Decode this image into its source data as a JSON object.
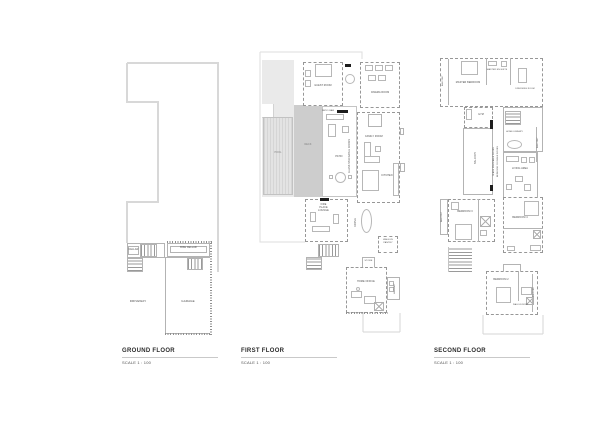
{
  "titles": {
    "ground": {
      "title": "GROUND FLOOR",
      "scale": "SCALE 1 : 100"
    },
    "first": {
      "title": "FIRST FLOOR",
      "scale": "SCALE 1 : 100"
    },
    "second": {
      "title": "SECOND FLOOR",
      "scale": "SCALE 1 : 100"
    }
  },
  "ground": {
    "rooms": {
      "bike_cellar": "BIKE CELLAR",
      "cellar": "CELLAR",
      "driveway": "DRIVEWAY",
      "garage": "GARAGE"
    }
  },
  "first": {
    "rooms": {
      "guest_room": "GUEST ROOM",
      "cinema_room": "CINEMA ROOM",
      "patio_bar": "PATIO BAR",
      "family_room": "FAMILY ROOM",
      "pool": "POOL",
      "deck": "DECK",
      "patio": "PATIO",
      "glass_doors": "GLASS STACKABLE DOORS",
      "kitchen": "KITCHEN",
      "fireplace_lounge": "FIRE PLACE LOUNGE",
      "dining": "DINING",
      "walk_in_pantry": "WALK-IN PANTRY",
      "store": "STORE",
      "home_office": "HOME OFFICE",
      "laundry": "LAUNDRY"
    }
  },
  "second": {
    "rooms": {
      "balcony": "BALCONY",
      "master_bedroom": "MASTER BEDROOM",
      "master_ensuite": "MASTER EN-SUITE",
      "dressing_room": "DRESSING ROOM",
      "gym": "GYM",
      "home_library": "HOME LIBRARY",
      "glass_doors": "GLASS STACKABLE DOORS",
      "double_doors": "BEDROOM 3 DOUBLE DOORS",
      "living_area": "LIVING AREA",
      "bedroom_2": "BEDROOM 2",
      "bedroom_3": "BEDROOM 3",
      "bedroom_4": "BEDROOM 4",
      "walk_in_robe": "WALK-IN ROBE"
    }
  },
  "colors": {
    "wall": "#8f8f8f",
    "thin_line": "#b3b3b3",
    "lot_line": "#d8d8d8",
    "deck_fill": "#cdcdcd",
    "paving_fill": "#eaeaea",
    "text": "#4a4a4a",
    "door_marker": "#1d1d1d"
  }
}
